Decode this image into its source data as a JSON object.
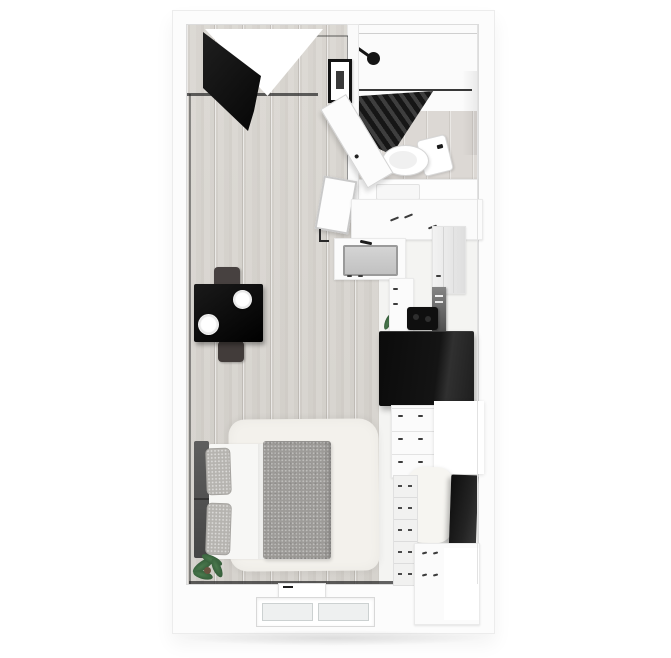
{
  "scene": {
    "title": "Studio apartment 3D floor plan",
    "description": "Top-down 3D rendering of a black-and-white studio apartment with light wood flooring",
    "background_color": "#ffffff"
  },
  "palette": {
    "wall_white": "#fcfcfc",
    "wood_floor": "#d8d5d0",
    "bathroom_floor": "#dcd8d4",
    "kitchen_floor": "#f4f4f2",
    "black_furniture": "#111111",
    "dark_gray": "#4a4441",
    "duvet_gray": "#9d9b98",
    "pillow_gray": "#b6b4b0",
    "rug_cream": "#f3f1ec",
    "plant_green": "#3c6b40",
    "baseboard": "#2c2c2c"
  },
  "rooms": [
    {
      "name": "main-living-area",
      "floor": "light wood planks"
    },
    {
      "name": "bathroom",
      "floor": "white shower zone + light wood"
    },
    {
      "name": "kitchen-strip",
      "floor": "white"
    }
  ],
  "furniture": [
    {
      "name": "entry-door",
      "color": "#141414",
      "state": "open"
    },
    {
      "name": "wall-art-frame",
      "color": "#141414"
    },
    {
      "name": "bathroom-door",
      "color": "#fcfcfc",
      "state": "open"
    },
    {
      "name": "shower-curtain",
      "color": "#2a2a2a"
    },
    {
      "name": "shower-head",
      "color": "#151515"
    },
    {
      "name": "toilet",
      "color": "#ffffff"
    },
    {
      "name": "bathroom-vanity",
      "color": "#fdfdfd"
    },
    {
      "name": "dining-table",
      "color": "#0c0c0c",
      "items": [
        "two white plates",
        "white flowers in vase",
        "cutlery"
      ]
    },
    {
      "name": "dining-chairs",
      "count": 2,
      "color": "#474140"
    },
    {
      "name": "kitchen-counter-with-sink",
      "color": "#fbfbfb"
    },
    {
      "name": "cooktop",
      "color": "#0f0f0f"
    },
    {
      "name": "oven-tower",
      "color": "#5e5e5e"
    },
    {
      "name": "refrigerator",
      "color": "#111111"
    },
    {
      "name": "kitchen-cabinets",
      "color": "#fafafa"
    },
    {
      "name": "leaning-mirror",
      "color": "#fdfdfd"
    },
    {
      "name": "bed",
      "headboard": "#555555",
      "duvet": "#9d9b98",
      "pillows": 2
    },
    {
      "name": "area-rug",
      "color": "#f3f1ec"
    },
    {
      "name": "potted-plant",
      "color": "#3c6b40"
    },
    {
      "name": "lounge-pouf",
      "color": "#f6f5f1"
    },
    {
      "name": "tv-panel",
      "color": "#1d1d1d",
      "state": "leaning on wall"
    },
    {
      "name": "drawer-tower",
      "color": "#f1f1f0"
    },
    {
      "name": "wall-heater",
      "color": "#ffffff"
    },
    {
      "name": "window",
      "location": "bottom wall",
      "panes": 2
    }
  ]
}
